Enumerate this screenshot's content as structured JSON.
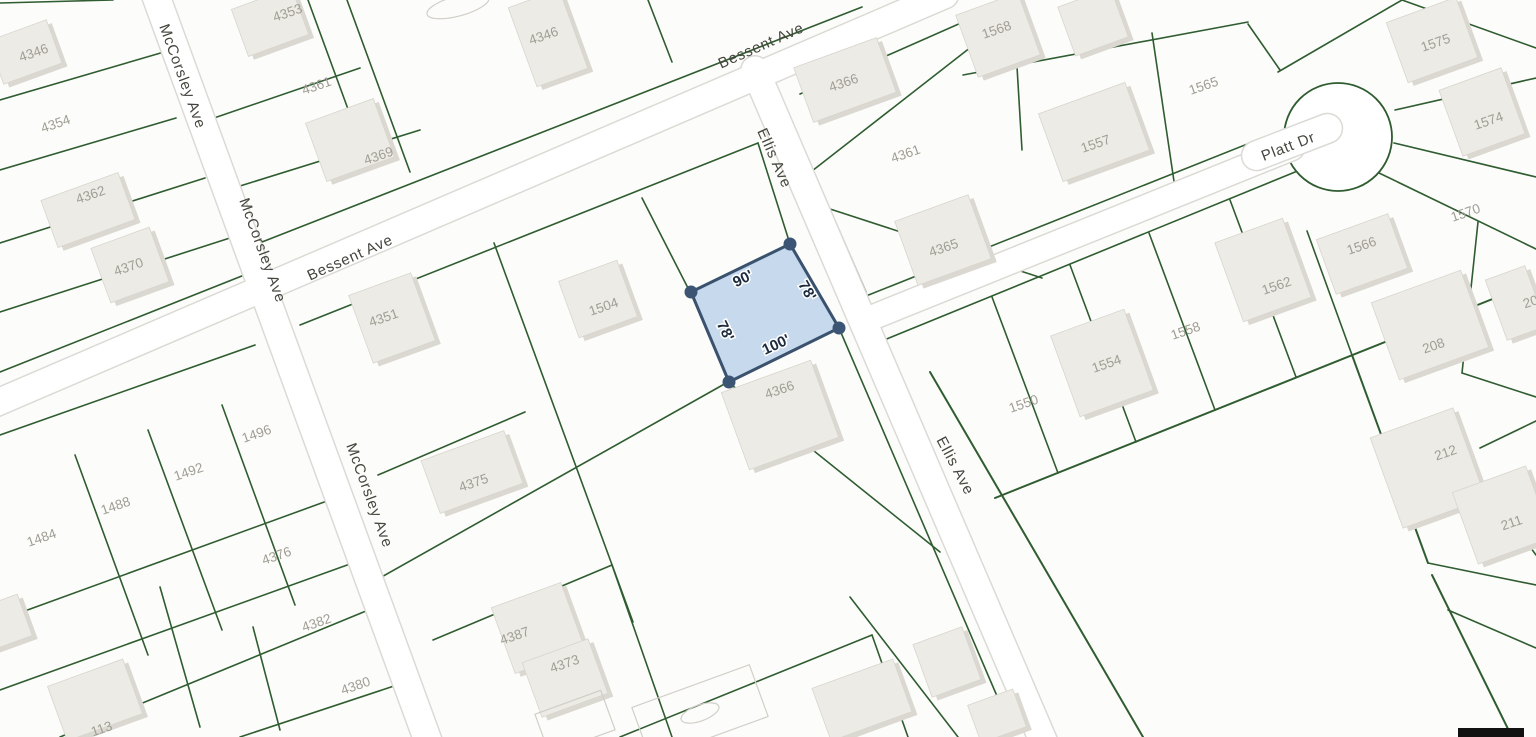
{
  "map": {
    "width": 1536,
    "height": 737,
    "colors": {
      "background": "#fcfcfa",
      "parcel_line": "#2f5c30",
      "road_fill": "#ffffff",
      "road_casing": "#dcdad5",
      "building_fill": "#edebe5",
      "building_shadow": "#dbd8d1",
      "building_stroke": "#d8d5ce",
      "parcel_label": "#a09d94",
      "street_label": "#45453e",
      "outline_stroke": "#d2cfc8",
      "highlight_fill": "rgba(125,170,219,0.42)",
      "highlight_stroke": "#3a526e",
      "vertex_fill": "#3d5574",
      "dimension_text": "#1c2b3d",
      "black_bar": "#111111"
    },
    "roads": [
      {
        "name": "McCorsley Ave",
        "x1": 150,
        "y1": -20,
        "x2": 435,
        "y2": 760,
        "width": 27
      },
      {
        "name": "Bessent Ave",
        "x1": -20,
        "y1": 410,
        "x2": 945,
        "y2": -5,
        "width": 26
      },
      {
        "name": "Ellis Ave",
        "x1": 755,
        "y1": 70,
        "x2": 1045,
        "y2": 745,
        "width": 27
      },
      {
        "name": "Platt Dr",
        "x1": 866,
        "y1": 320,
        "x2": 1292,
        "y2": 148,
        "width": 24
      }
    ],
    "culdesac": {
      "cx": 1338,
      "cy": 137,
      "r": 54,
      "pill": {
        "cx": 1292,
        "cy": 142,
        "w": 106,
        "h": 30,
        "rot": -21
      }
    },
    "parcel_lines": [
      [
        0,
        3,
        113,
        0
      ],
      [
        0,
        100,
        164,
        52
      ],
      [
        0,
        170,
        176,
        118
      ],
      [
        0,
        243,
        205,
        178
      ],
      [
        0,
        312,
        233,
        237
      ],
      [
        0,
        372,
        262,
        268
      ],
      [
        0,
        435,
        255,
        345
      ],
      [
        75,
        455,
        148,
        655
      ],
      [
        148,
        430,
        222,
        630
      ],
      [
        222,
        405,
        295,
        605
      ],
      [
        0,
        620,
        327,
        501
      ],
      [
        0,
        690,
        350,
        564
      ],
      [
        60,
        737,
        366,
        611
      ],
      [
        240,
        737,
        394,
        686
      ],
      [
        160,
        587,
        200,
        727
      ],
      [
        253,
        627,
        280,
        730
      ],
      [
        262,
        242,
        862,
        7
      ],
      [
        308,
        0,
        352,
        120
      ],
      [
        347,
        0,
        410,
        172
      ],
      [
        214,
        118,
        360,
        68
      ],
      [
        240,
        186,
        420,
        130
      ],
      [
        648,
        0,
        672,
        62
      ],
      [
        800,
        94,
        1013,
        0
      ],
      [
        300,
        325,
        758,
        143
      ],
      [
        758,
        143,
        790,
        244
      ],
      [
        839,
        328,
        1012,
        731
      ],
      [
        642,
        198,
        690,
        292
      ],
      [
        494,
        243,
        633,
        622
      ],
      [
        378,
        579,
        728,
        382
      ],
      [
        728,
        382,
        940,
        552
      ],
      [
        378,
        475,
        525,
        412
      ],
      [
        433,
        640,
        612,
        565
      ],
      [
        612,
        565,
        672,
        737
      ],
      [
        620,
        737,
        872,
        635
      ],
      [
        872,
        635,
        908,
        737
      ],
      [
        850,
        597,
        958,
        737
      ],
      [
        786,
        108,
        866,
        292
      ],
      [
        866,
        296,
        1295,
        125
      ],
      [
        812,
        171,
        980,
        40
      ],
      [
        827,
        208,
        1042,
        278
      ],
      [
        1013,
        0,
        1022,
        150
      ],
      [
        963,
        75,
        1248,
        22
      ],
      [
        1152,
        33,
        1175,
        188
      ],
      [
        1248,
        24,
        1280,
        70
      ],
      [
        872,
        345,
        1300,
        170
      ],
      [
        992,
        297,
        1058,
        473
      ],
      [
        1070,
        265,
        1136,
        442
      ],
      [
        1149,
        233,
        1215,
        410
      ],
      [
        1230,
        200,
        1296,
        377
      ],
      [
        995,
        498,
        1520,
        288,
        2
      ],
      [
        930,
        372,
        1143,
        737,
        2
      ],
      [
        1352,
        355,
        1428,
        563,
        2
      ],
      [
        1428,
        563,
        1536,
        585
      ],
      [
        1432,
        575,
        1512,
        737,
        2
      ],
      [
        1448,
        610,
        1536,
        648
      ],
      [
        1278,
        72,
        1402,
        0
      ],
      [
        1402,
        0,
        1536,
        48
      ],
      [
        1395,
        110,
        1536,
        78
      ],
      [
        1394,
        143,
        1536,
        177
      ],
      [
        1377,
        172,
        1536,
        249
      ],
      [
        1307,
        231,
        1352,
        355
      ],
      [
        1478,
        222,
        1462,
        373
      ],
      [
        1462,
        373,
        1536,
        397
      ],
      [
        1463,
        455,
        1536,
        555
      ],
      [
        1480,
        448,
        1536,
        421
      ]
    ],
    "buildings": [
      [
        270,
        22,
        64,
        50,
        -20
      ],
      [
        25,
        52,
        62,
        46,
        -20
      ],
      [
        88,
        210,
        82,
        50,
        -20
      ],
      [
        130,
        265,
        62,
        58,
        -20
      ],
      [
        350,
        140,
        72,
        62,
        -20
      ],
      [
        548,
        38,
        54,
        84,
        -20
      ],
      [
        392,
        318,
        66,
        72,
        -20
      ],
      [
        598,
        299,
        62,
        60,
        -20
      ],
      [
        780,
        415,
        95,
        82,
        -20
      ],
      [
        472,
        472,
        88,
        56,
        -20
      ],
      [
        538,
        628,
        74,
        70,
        -20
      ],
      [
        565,
        678,
        70,
        58,
        -20
      ],
      [
        845,
        80,
        88,
        58,
        -20
      ],
      [
        998,
        35,
        66,
        66,
        -20
      ],
      [
        1093,
        22,
        56,
        52,
        -20
      ],
      [
        1094,
        132,
        92,
        72,
        -20
      ],
      [
        943,
        240,
        78,
        68,
        -20
      ],
      [
        1432,
        40,
        74,
        64,
        -20
      ],
      [
        1482,
        112,
        66,
        70,
        -20
      ],
      [
        1362,
        254,
        76,
        58,
        -20
      ],
      [
        1263,
        270,
        72,
        84,
        -20
      ],
      [
        1102,
        363,
        78,
        86,
        -20
      ],
      [
        1430,
        325,
        95,
        82,
        -20
      ],
      [
        1516,
        303,
        42,
        64,
        -20
      ],
      [
        1428,
        468,
        88,
        96,
        -20
      ],
      [
        1502,
        515,
        78,
        76,
        -20
      ],
      [
        95,
        700,
        80,
        58,
        -20
      ],
      [
        862,
        700,
        86,
        56,
        -20
      ],
      [
        947,
        662,
        52,
        56,
        -20
      ],
      [
        997,
        716,
        48,
        40,
        -20
      ],
      [
        5,
        622,
        42,
        44,
        -20
      ]
    ],
    "outlines": [
      {
        "type": "rect",
        "cx": 700,
        "cy": 712,
        "w": 125,
        "h": 55,
        "rot": -20
      },
      {
        "type": "ellipse",
        "cx": 700,
        "cy": 713,
        "rx": 20,
        "ry": 8,
        "rot": -20
      },
      {
        "type": "rect",
        "cx": 575,
        "cy": 722,
        "w": 70,
        "h": 42,
        "rot": -20
      },
      {
        "type": "ellipse",
        "cx": 458,
        "cy": 6,
        "rx": 32,
        "ry": 10,
        "rot": -15
      }
    ],
    "street_labels": [
      {
        "text": "McCorsley Ave",
        "x": 178,
        "y": 78,
        "rot": 70
      },
      {
        "text": "McCorsley Ave",
        "x": 258,
        "y": 252,
        "rot": 70
      },
      {
        "text": "McCorsley Ave",
        "x": 365,
        "y": 497,
        "rot": 70
      },
      {
        "text": "Bessent Ave",
        "x": 763,
        "y": 50,
        "rot": -24
      },
      {
        "text": "Bessent Ave",
        "x": 352,
        "y": 262,
        "rot": -24
      },
      {
        "text": "Ellis Ave",
        "x": 770,
        "y": 160,
        "rot": 66
      },
      {
        "text": "Ellis Ave",
        "x": 951,
        "y": 468,
        "rot": 62
      },
      {
        "text": "Platt Dr",
        "x": 1290,
        "y": 151,
        "rot": -21
      }
    ],
    "parcel_labels": [
      {
        "text": "4346",
        "x": 35,
        "y": 57
      },
      {
        "text": "4354",
        "x": 57,
        "y": 128
      },
      {
        "text": "4362",
        "x": 92,
        "y": 199
      },
      {
        "text": "4370",
        "x": 130,
        "y": 271
      },
      {
        "text": "4353",
        "x": 289,
        "y": 17
      },
      {
        "text": "4361",
        "x": 318,
        "y": 90
      },
      {
        "text": "4369",
        "x": 380,
        "y": 160
      },
      {
        "text": "4346",
        "x": 545,
        "y": 40
      },
      {
        "text": "4351",
        "x": 385,
        "y": 322
      },
      {
        "text": "1504",
        "x": 605,
        "y": 311
      },
      {
        "text": "4366",
        "x": 781,
        "y": 394
      },
      {
        "text": "4375",
        "x": 475,
        "y": 487
      },
      {
        "text": "4387",
        "x": 516,
        "y": 640
      },
      {
        "text": "4373",
        "x": 566,
        "y": 668
      },
      {
        "text": "1496",
        "x": 258,
        "y": 438
      },
      {
        "text": "1492",
        "x": 190,
        "y": 476
      },
      {
        "text": "1488",
        "x": 117,
        "y": 510
      },
      {
        "text": "1484",
        "x": 43,
        "y": 542
      },
      {
        "text": "4376",
        "x": 278,
        "y": 560
      },
      {
        "text": "4382",
        "x": 318,
        "y": 627
      },
      {
        "text": "4380",
        "x": 357,
        "y": 690
      },
      {
        "text": "113",
        "x": 103,
        "y": 733
      },
      {
        "text": "4366",
        "x": 845,
        "y": 87
      },
      {
        "text": "4361",
        "x": 907,
        "y": 158
      },
      {
        "text": "4365",
        "x": 945,
        "y": 252
      },
      {
        "text": "1568",
        "x": 998,
        "y": 34
      },
      {
        "text": "1565",
        "x": 1205,
        "y": 90
      },
      {
        "text": "1557",
        "x": 1097,
        "y": 148
      },
      {
        "text": "1550",
        "x": 1025,
        "y": 408
      },
      {
        "text": "1554",
        "x": 1108,
        "y": 368
      },
      {
        "text": "1558",
        "x": 1187,
        "y": 335
      },
      {
        "text": "1562",
        "x": 1278,
        "y": 290
      },
      {
        "text": "1575",
        "x": 1437,
        "y": 47
      },
      {
        "text": "1574",
        "x": 1490,
        "y": 125
      },
      {
        "text": "1570",
        "x": 1467,
        "y": 217
      },
      {
        "text": "1566",
        "x": 1363,
        "y": 250
      },
      {
        "text": "208",
        "x": 1435,
        "y": 350
      },
      {
        "text": "212",
        "x": 1447,
        "y": 457
      },
      {
        "text": "211",
        "x": 1513,
        "y": 527
      },
      {
        "text": "20",
        "x": 1532,
        "y": 306
      }
    ],
    "subject_lot": {
      "points": "790,244 839,328 729,382 691,292",
      "vertices": [
        [
          790,
          244
        ],
        [
          839,
          328
        ],
        [
          729,
          382
        ],
        [
          691,
          292
        ]
      ],
      "dimensions": [
        {
          "text": "90'",
          "x": 745,
          "y": 283,
          "rot": -26
        },
        {
          "text": "78'",
          "x": 803,
          "y": 293,
          "rot": 60
        },
        {
          "text": "78'",
          "x": 721,
          "y": 333,
          "rot": 64
        },
        {
          "text": "100'",
          "x": 778,
          "y": 349,
          "rot": -25
        }
      ]
    },
    "black_bar": {
      "x": 1458,
      "y": 728,
      "w": 66,
      "h": 9
    }
  }
}
